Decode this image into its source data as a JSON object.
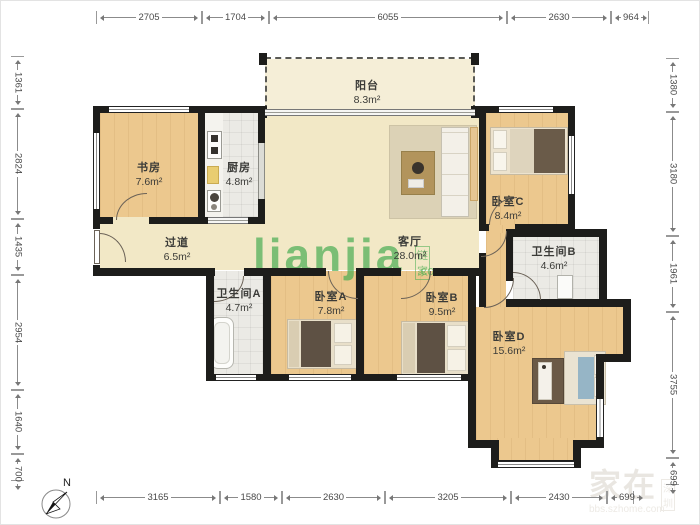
{
  "plan_title": "apartment-floor-plan",
  "colors": {
    "wall": "#1d1d1b",
    "wood_floor": "#ecc88e",
    "cream_floor": "#f2e8c6",
    "tile_floor": "#ebeae5",
    "watermark_green": "#49ad52"
  },
  "compass": {
    "label": "N"
  },
  "watermark_center": {
    "brand": "lianjia",
    "brand_cn": "链家",
    "brand_suffix": ".com"
  },
  "watermark_corner": {
    "main": "家在",
    "badge": "深圳",
    "url": "bbs.szhome.com"
  },
  "rooms": [
    {
      "id": "study",
      "name": "书房",
      "area": "7.6m²",
      "x": 148,
      "y": 170
    },
    {
      "id": "kitchen",
      "name": "厨房",
      "area": "4.8m²",
      "x": 238,
      "y": 170
    },
    {
      "id": "balcony",
      "name": "阳台",
      "area": "8.3m²",
      "x": 366,
      "y": 88
    },
    {
      "id": "living",
      "name": "客厅",
      "area": "28.0m²",
      "x": 409,
      "y": 244
    },
    {
      "id": "hall",
      "name": "过道",
      "area": "6.5m²",
      "x": 176,
      "y": 245
    },
    {
      "id": "bathA",
      "name": "卫生间A",
      "area": "4.7m²",
      "x": 238,
      "y": 296
    },
    {
      "id": "bedA",
      "name": "卧室A",
      "area": "7.8m²",
      "x": 330,
      "y": 299
    },
    {
      "id": "bedB",
      "name": "卧室B",
      "area": "9.5m²",
      "x": 441,
      "y": 300
    },
    {
      "id": "bedC",
      "name": "卧室C",
      "area": "8.4m²",
      "x": 507,
      "y": 204
    },
    {
      "id": "bathB",
      "name": "卫生间B",
      "area": "4.6m²",
      "x": 553,
      "y": 254
    },
    {
      "id": "bedD",
      "name": "卧室D",
      "area": "15.6m²",
      "x": 508,
      "y": 339
    }
  ],
  "dimensions": {
    "top": [
      "2705",
      "1704",
      "6055",
      "2630",
      "964"
    ],
    "bottom": [
      "3165",
      "1580",
      "2630",
      "3205",
      "2430",
      "699"
    ],
    "left": [
      "1361",
      "2824",
      "1435",
      "2954",
      "1640",
      "700"
    ],
    "right": [
      "1380",
      "3180",
      "1961",
      "3755",
      "699"
    ]
  }
}
